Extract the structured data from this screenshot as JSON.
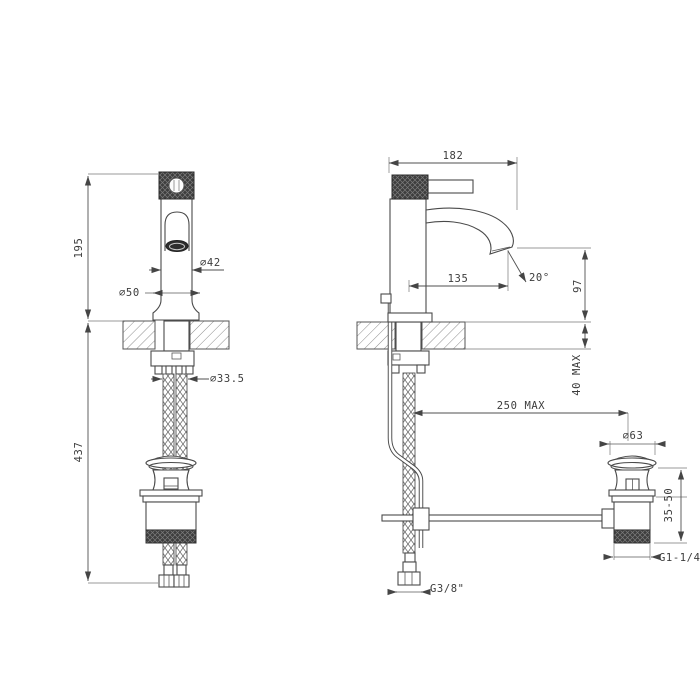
{
  "drawing": {
    "kind": "basin-mixer-technical-drawing",
    "line_color": "#4a4a4a",
    "background": "#ffffff",
    "knurl_color": "#3d3d3d"
  },
  "dims": {
    "front": {
      "height_above_deck": "195",
      "height_below_deck": "437",
      "body_diameter": "∅42",
      "base_diameter": "∅50",
      "hole_diameter": "∅33.5"
    },
    "side": {
      "total_depth": "182",
      "spout_reach": "135",
      "spout_angle": "20°",
      "spout_height": "97",
      "deck_thickness": "40 MAX",
      "drain_distance": "250 MAX"
    },
    "drain": {
      "cap_diameter": "∅63",
      "height_range": "35-50",
      "drain_thread": "G1-1/4\"",
      "supply_thread": "G3/8\""
    }
  }
}
